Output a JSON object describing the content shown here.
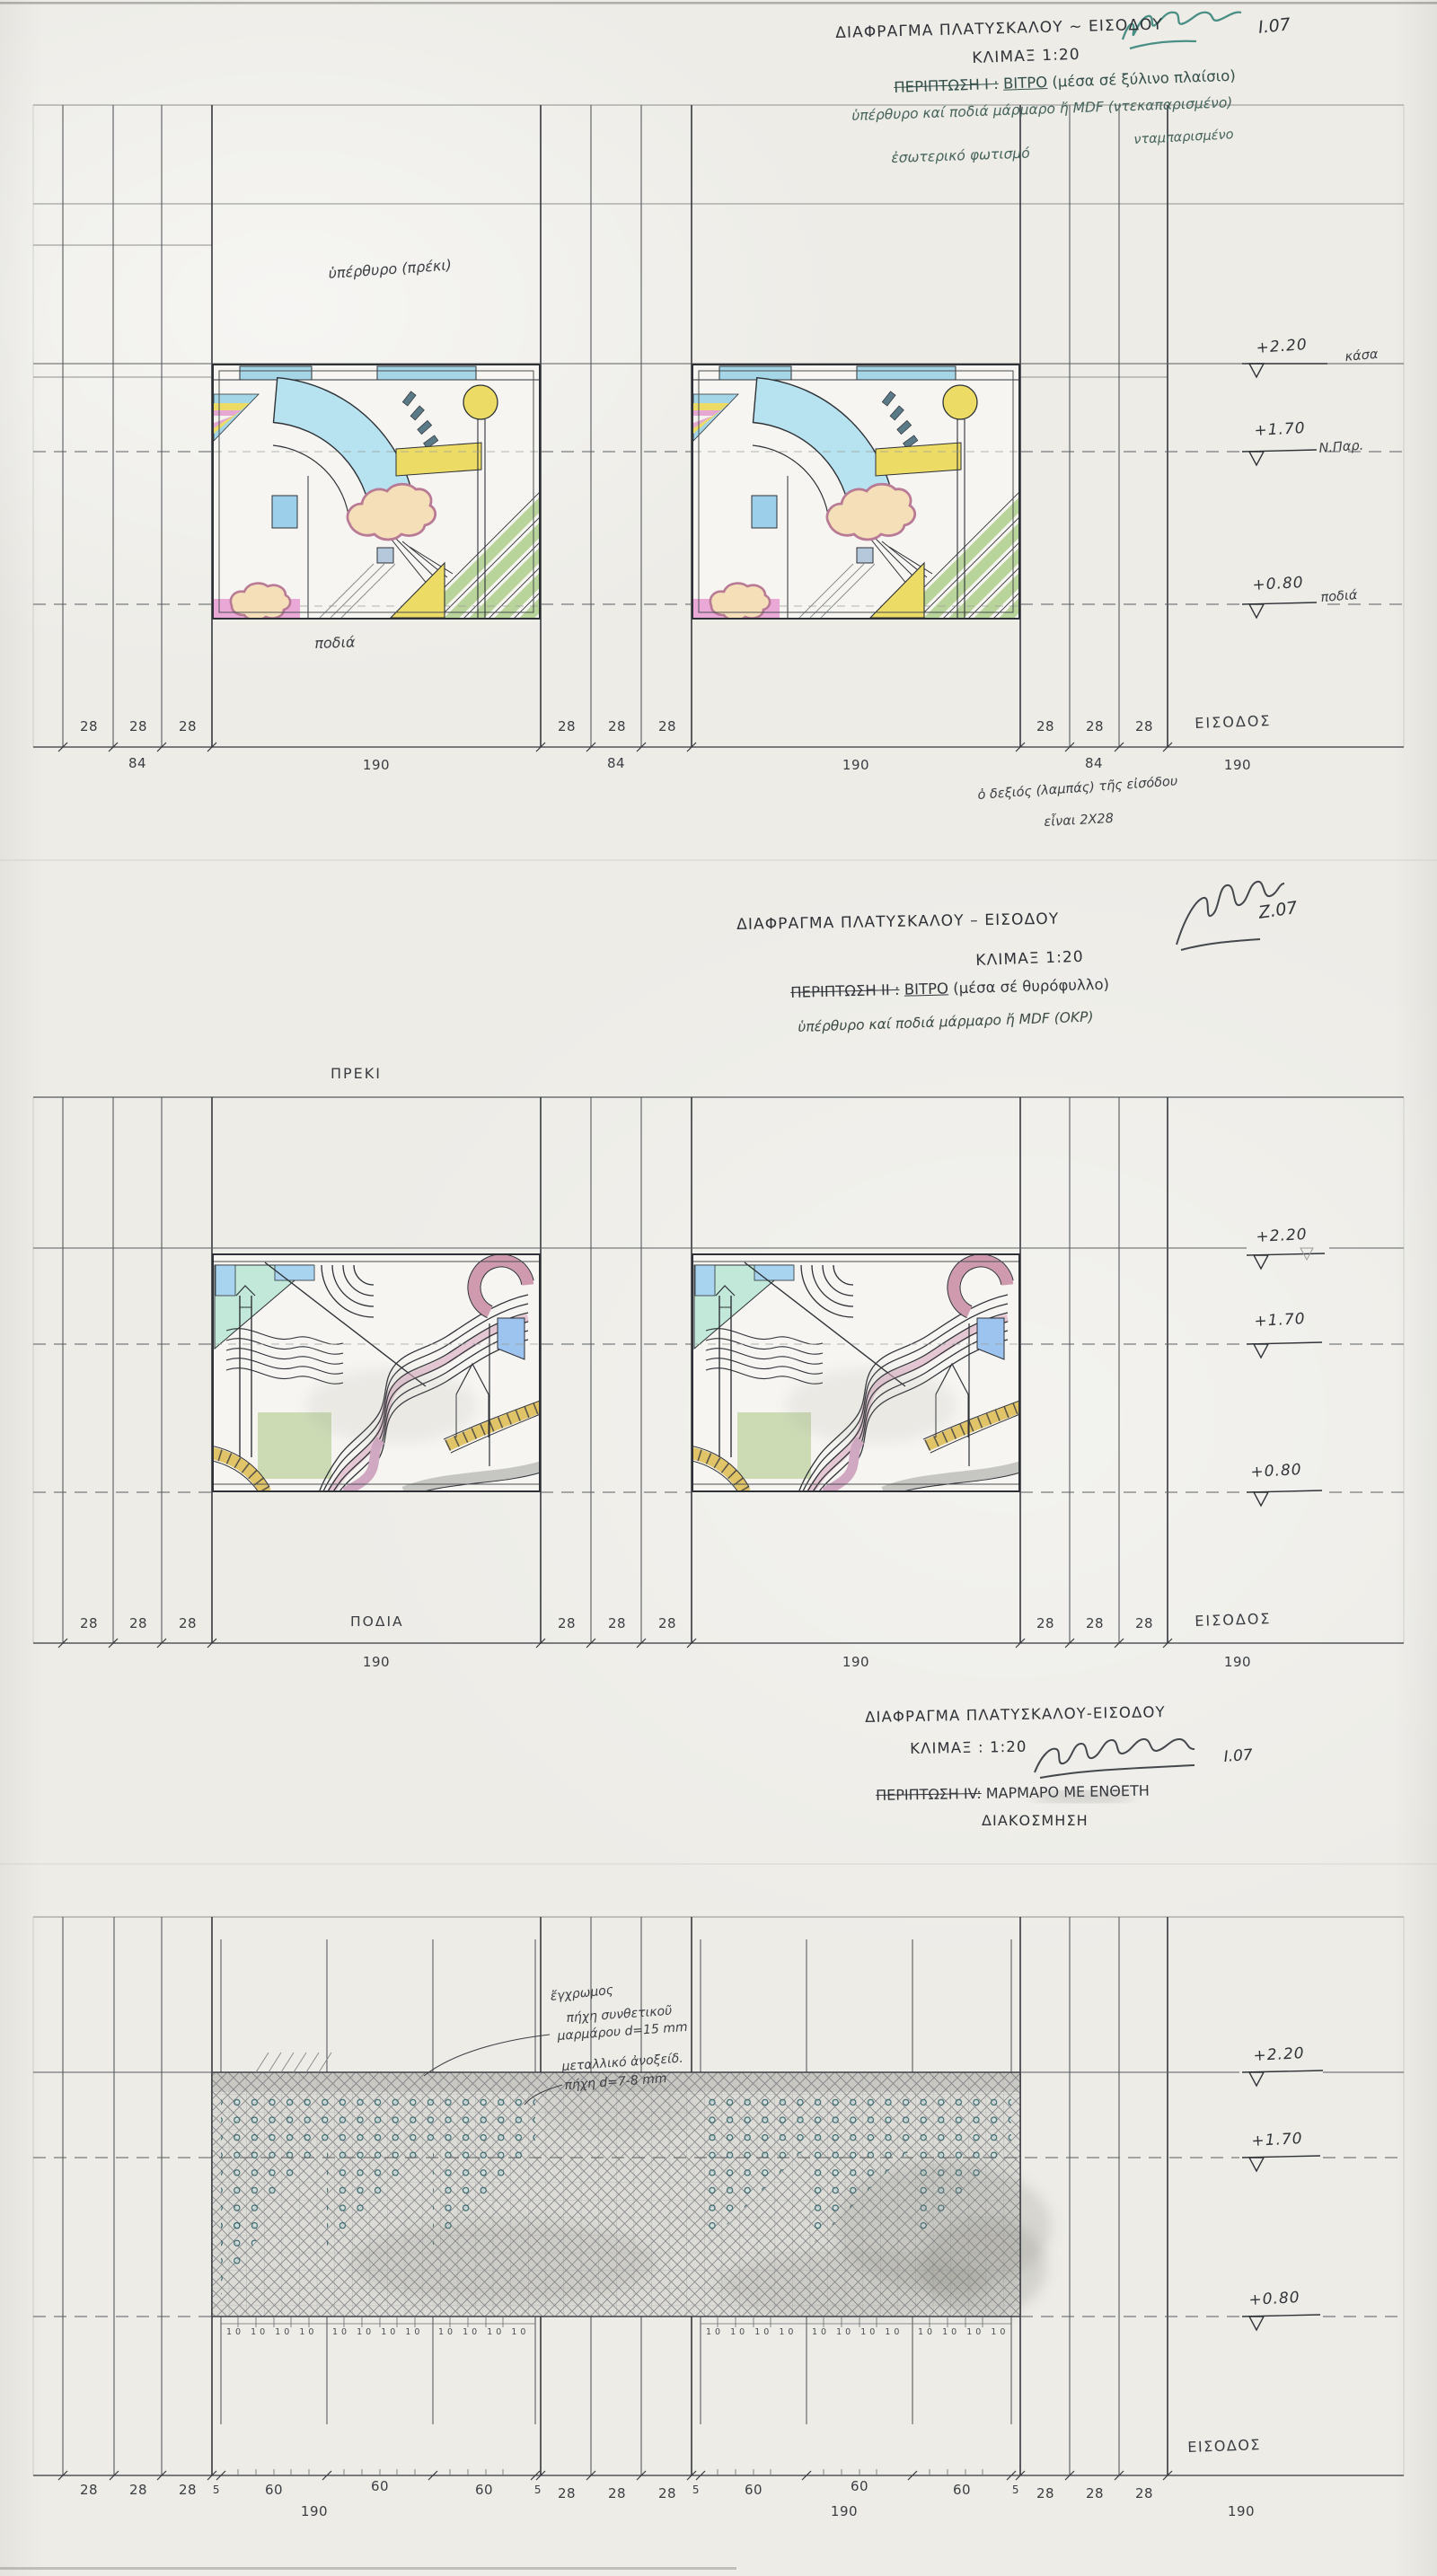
{
  "document": {
    "type": "hand-drawn architectural detail sheet (scan)",
    "language": "Greek",
    "palette": {
      "paper": "#edece7",
      "pencil_ink": "#34373c",
      "teal_note_ink": "#46635c",
      "signature_teal": "#2e7f74",
      "glass_blue": "#b7e2ef",
      "glass_yellow": "#ecdc66",
      "glass_pink": "#e9a8d6",
      "glass_green": "#b9d49a",
      "glass_cream": "#f4dfb8",
      "glass_mint": "#c2e8da",
      "inlay_dot_teal": "#2f5f66"
    }
  },
  "s1": {
    "title1": "ΔΙΑΦΡΑΓΜΑ ΠΛΑΤΥΣΚΑΛΟΥ ~ ΕΙΣΟΔΟΥ",
    "title2": "ΚΛΙΜΑΞ 1:20",
    "sig_date": "Ι.07",
    "case_label": "ΠΕΡΙΠΤΩΣΗ Ι :",
    "case_value_u": "ΒΙΤΡΟ",
    "case_value_rest": "(μέσα σέ ξύλινο πλαίσιο)",
    "note1": "ὑπέρθυρο καί ποδιά μάρμαρο ἤ MDF (ντεκαπαρισμένο)",
    "note2": "νταμπαρισμένο",
    "note3": "ἐσωτερικό φωτισμό",
    "lintel_label": "ὑπέρθυρο (πρέκι)",
    "sill_label": "ποδιά",
    "lv1": "+2.20",
    "lv1_label": "κάσα",
    "lv2": "+1.70",
    "lv2_label": "Ν.Παρ.",
    "lv3": "+0.80",
    "lv3_label": "ποδιά",
    "d28": "28",
    "d84": "84",
    "d190": "190",
    "entrance": "ΕΙΣΟΔΟΣ",
    "foot1": "ὁ δεξιός (λαμπάς) τῆς εἰσόδου",
    "foot2": "εἶναι 2Χ28"
  },
  "s2": {
    "title1": "ΔΙΑΦΡΑΓΜΑ ΠΛΑΤΥΣΚΑΛΟΥ – ΕΙΣΟΔΟΥ",
    "title2": "ΚΛΙΜΑΞ 1:20",
    "sig_date": "Ζ.07",
    "case_label": "ΠΕΡΙΠΤΩΣΗ ΙΙ :",
    "case_value_u": "ΒΙΤΡΟ",
    "case_value_rest": "(μέσα σέ θυρόφυλλο)",
    "note1": "ὑπέρθυρο καί ποδιά μάρμαρο ἤ MDF (ΟΚΡ)",
    "lintel_label": "ΠΡΕΚΙ",
    "sill_label": "ΠΟΔΙΑ",
    "lv1": "+2.20",
    "lv2": "+1.70",
    "lv3": "+0.80",
    "d28": "28",
    "d190": "190",
    "entrance": "ΕΙΣΟΔΟΣ"
  },
  "s3": {
    "title1": "ΔΙΑΦΡΑΓΜΑ ΠΛΑΤΥΣΚΑΛΟΥ-ΕΙΣΟΔΟΥ",
    "title2": "ΚΛΙΜΑΞ : 1:20",
    "sig_date": "Ι.07",
    "case_label": "ΠΕΡΙΠΤΩΣΗ ΙV:",
    "case_value": "ΜΑΡΜΑΡΟ ΜΕ ΕΝΘΕΤΗ",
    "case_line2": "ΔΙΑΚΟΣΜΗΣΗ",
    "ann1a": "ἔγχρωμος",
    "ann1b": "πήχη συνθετικοῦ",
    "ann1c": "μαρμάρου d=15 mm",
    "ann2a": "μεταλλικό ἀνοξείδ.",
    "ann2b": "πήχη d=7-8 mm",
    "lv1": "+2.20",
    "lv2": "+1.70",
    "lv3": "+0.80",
    "d28": "28",
    "d5": "5",
    "d60": "60",
    "d190": "190",
    "ticks10": "10 10 10 10",
    "entrance": "ΕΙΣΟΔΟΣ"
  }
}
